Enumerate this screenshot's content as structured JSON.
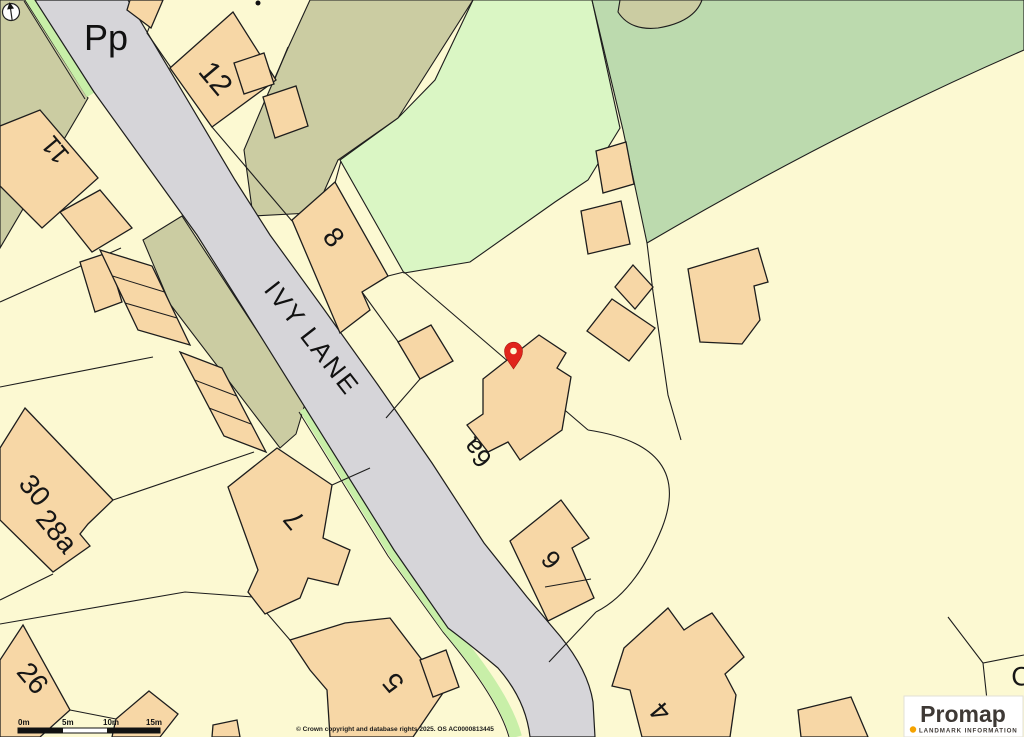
{
  "map": {
    "road_label": "IVY LANE",
    "area_label": "Pp",
    "partial_edge_label": "C",
    "plots": {
      "n12": "12",
      "n11": "11",
      "n8": "8",
      "n30": "30",
      "n28a": "28a",
      "n26": "26",
      "n7": "7",
      "n5": "5",
      "n6a": "6a",
      "n6": "6",
      "n4": "4"
    }
  },
  "scale_bar": {
    "labels": [
      "0m",
      "5m",
      "10m",
      "15m"
    ]
  },
  "attribution": {
    "text": "© Crown copyright and database rights 2025. OS AC0000813445"
  },
  "logo": {
    "brand": "Promap",
    "tagline": "LANDMARK INFORMATION"
  },
  "colors": {
    "background": "#FCF9D2",
    "road": "#D6D5D9",
    "building": "#F7D7A6",
    "verge_green": "#C8EFA8",
    "field_light_green": "#DAF6C4",
    "field_medium_green": "#BCDAAE",
    "track_olive": "#CBCCA2",
    "pin_red": "#E0241C",
    "logo_accent": "#F5A300"
  }
}
